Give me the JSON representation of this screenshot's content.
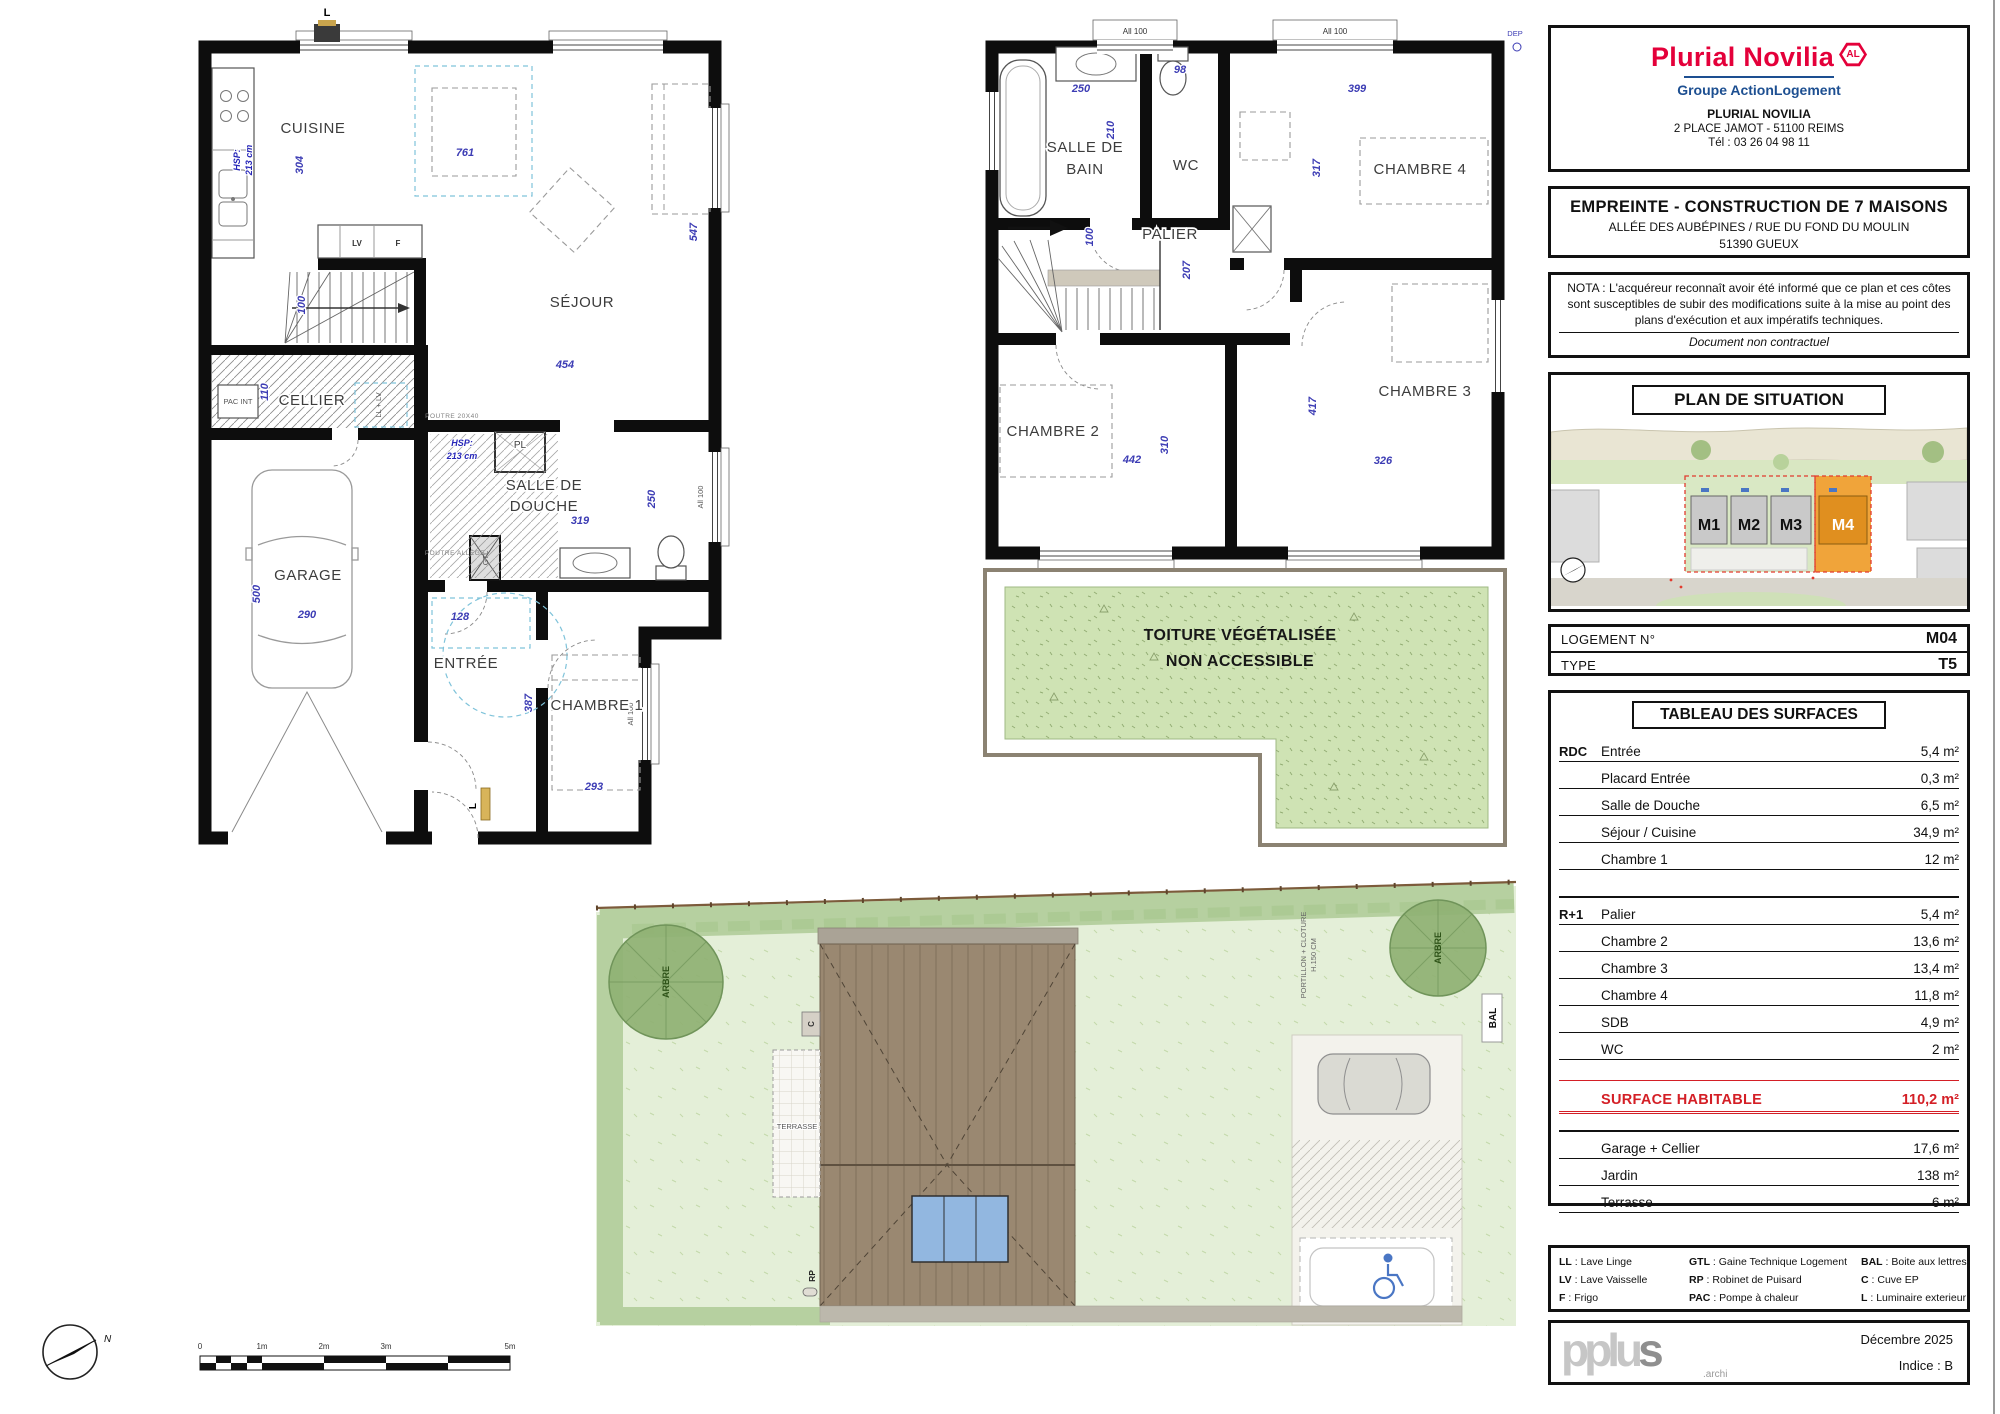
{
  "colors": {
    "brand_magenta": "#e4003a",
    "brand_blue": "#1d4f91",
    "surface_red": "#d41f26",
    "m4_orange": "#f0a43a",
    "dim_blue": "#3c3cb4",
    "roof_green": "#cfe3b4"
  },
  "sep": ":",
  "panel": {
    "logo": {
      "brand": "Plurial Novilia",
      "badge": "AL",
      "group": "Groupe ActionLogement",
      "name": "PLURIAL NOVILIA",
      "address": "2 PLACE JAMOT - 51100 REIMS",
      "phone": "Tél : 03 26 04 98 11"
    },
    "project": {
      "title": "EMPREINTE - CONSTRUCTION DE 7 MAISONS",
      "line1": "ALLÉE DES AUBÉPINES / RUE DU FOND DU MOULIN",
      "line2": "51390 GUEUX"
    },
    "nota": {
      "line1": "NOTA : L'acquéreur reconnaît avoir été informé que ce plan et ces côtes sont",
      "line2": "susceptibles de subir des modifications suite à la mise au point des plans",
      "line3": "d'exécution et aux impératifs techniques.",
      "footer": "Document non contractuel"
    },
    "situation": {
      "title": "PLAN DE SITUATION",
      "m1": "M1",
      "m2": "M2",
      "m3": "M3",
      "m4": "M4"
    },
    "logement": {
      "label": "LOGEMENT N°",
      "value": "M04",
      "type_label": "TYPE",
      "type_value": "T5"
    },
    "surfaces": {
      "title": "TABLEAU DES SURFACES",
      "rdc_label": "RDC",
      "r1_label": "R+1",
      "rdc_rows": [
        [
          "Entrée",
          "5,4 m²"
        ],
        [
          "Placard Entrée",
          "0,3 m²"
        ],
        [
          "Salle de Douche",
          "6,5 m²"
        ],
        [
          "Séjour / Cuisine",
          "34,9 m²"
        ],
        [
          "Chambre 1",
          "12 m²"
        ]
      ],
      "r1_rows": [
        [
          "Palier",
          "5,4 m²"
        ],
        [
          "Chambre 2",
          "13,6 m²"
        ],
        [
          "Chambre 3",
          "13,4 m²"
        ],
        [
          "Chambre 4",
          "11,8 m²"
        ],
        [
          "SDB",
          "4,9 m²"
        ],
        [
          "WC",
          "2 m²"
        ]
      ],
      "total_label": "SURFACE HABITABLE",
      "total_value": "110,2 m²",
      "annex_rows": [
        [
          "Garage + Cellier",
          "17,6 m²"
        ],
        [
          "Jardin",
          "138 m²"
        ],
        [
          "Terrasse",
          "6 m²"
        ]
      ]
    },
    "legend": {
      "col1": [
        [
          "LL",
          "Lave Linge"
        ],
        [
          "LV",
          "Lave Vaisselle"
        ],
        [
          "F",
          "Frigo"
        ]
      ],
      "col2": [
        [
          "GTL",
          "Gaine Technique Logement"
        ],
        [
          "RP",
          "Robinet de Puisard"
        ],
        [
          "PAC",
          "Pompe à chaleur"
        ]
      ],
      "col3": [
        [
          "BAL",
          "Boite aux lettres"
        ],
        [
          "C",
          "Cuve EP"
        ],
        [
          "L",
          "Luminaire exterieur"
        ]
      ]
    },
    "titleblock": {
      "logo": "pplu",
      "logo_s": "s",
      "archi": ".archi",
      "date": "Décembre 2025",
      "indice": "Indice : B"
    }
  },
  "rdc": {
    "labels": {
      "cuisine": "CUISINE",
      "sejour": "SÉJOUR",
      "cellier": "CELLIER",
      "garage": "GARAGE",
      "entree": "ENTRÉE",
      "douche_l1": "SALLE DE",
      "douche_l2": "DOUCHE",
      "chambre1": "CHAMBRE 1",
      "pl": "PL",
      "pac": "PAC INT",
      "lv": "LV",
      "f": "F",
      "ll_lv": "LL + LV",
      "gtl": "GTL",
      "lum": "L",
      "hsp_l1": "HSP:",
      "hsp_l2": "213 cm",
      "poutre1": "POUTRE 20X40",
      "poutre2": "POUTRE ALLÈGE",
      "allege": "All 100"
    },
    "dims": {
      "d304": "304",
      "d761": "761",
      "d547": "547",
      "d454": "454",
      "d100": "100",
      "d110": "110",
      "d500": "500",
      "d290": "290",
      "d128": "128",
      "d387": "387",
      "d319": "319",
      "d250": "250",
      "d293": "293"
    }
  },
  "r1": {
    "labels": {
      "sdb_l1": "SALLE DE",
      "sdb_l2": "BAIN",
      "wc": "WC",
      "palier": "PALIER",
      "ch2": "CHAMBRE 2",
      "ch3": "CHAMBRE 3",
      "ch4": "CHAMBRE 4",
      "window": "All 100",
      "dep": "DEP"
    },
    "dims": {
      "d250": "250",
      "d210": "210",
      "d98": "98",
      "d399": "399",
      "d317": "317",
      "d100": "100",
      "d207": "207",
      "d442": "442",
      "d310": "310",
      "d326": "326",
      "d417": "417"
    },
    "roof": {
      "l1": "TOITURE VÉGÉTALISÉE",
      "l2": "NON ACCESSIBLE"
    }
  },
  "garden": {
    "labels": {
      "terrasse": "TERRASSE",
      "arbre": "ARBRE",
      "bal": "BAL",
      "rp": "RP",
      "c": "C",
      "portillon_l1": "PORTILLON + CLOTURE",
      "portillon_l2": "H.150 CM"
    }
  },
  "page": {
    "north": "N",
    "scalebar": [
      "0",
      "1m",
      "2m",
      "3m",
      "5m"
    ]
  }
}
